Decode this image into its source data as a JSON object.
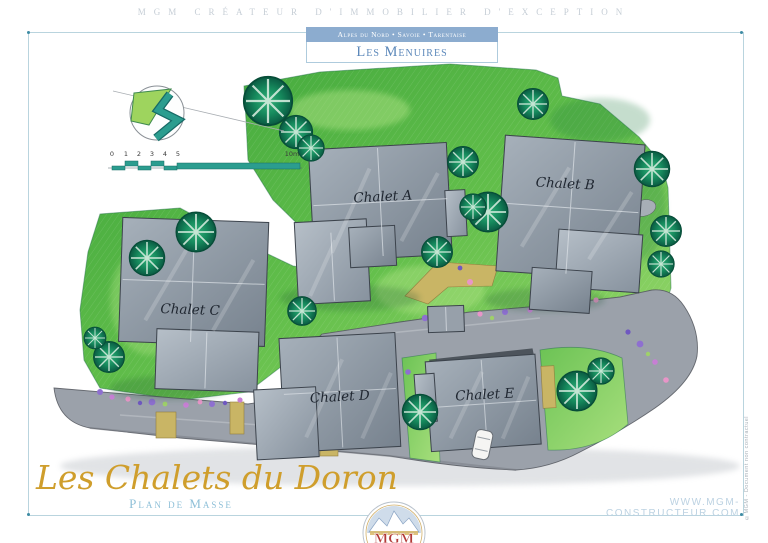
{
  "header": {
    "tagline": "MGM CRÉATEUR D'IMMOBILIER D'EXCEPTION",
    "banner": {
      "region": "Alpes du Nord • Savoie • Tarentaise",
      "resort": "Les Menuires"
    }
  },
  "plan": {
    "chalets": [
      {
        "label": "Chalet A"
      },
      {
        "label": "Chalet B"
      },
      {
        "label": "Chalet C"
      },
      {
        "label": "Chalet D"
      },
      {
        "label": "Chalet E"
      }
    ],
    "scale": {
      "ticks": [
        "0",
        "1",
        "2",
        "3",
        "4",
        "5"
      ],
      "max_label": "10m"
    },
    "icons": {
      "compass": "north-arrow-icon"
    }
  },
  "footer": {
    "title": "Les Chalets du Doron",
    "subtitle": "Plan de Masse",
    "website": "WWW.MGM-CONSTRUCTEUR.COM",
    "credit": "©MGM - Document non contractuel",
    "logo_text": "MGM"
  },
  "colors": {
    "banner_blue": "#8caccf",
    "resort_text": "#5c88ba",
    "title_gold": "#cf9e2c",
    "subtitle_blue": "#8fc0d8",
    "frame_blue": "#b9d4de",
    "grass_green": "#57b845",
    "tree_teal": "#0e6b52",
    "roof_gray": "#8c96a2",
    "road_gray": "#9ba1aa",
    "flower_purple": "#8e6fd0",
    "path_tan": "#c9b565"
  }
}
